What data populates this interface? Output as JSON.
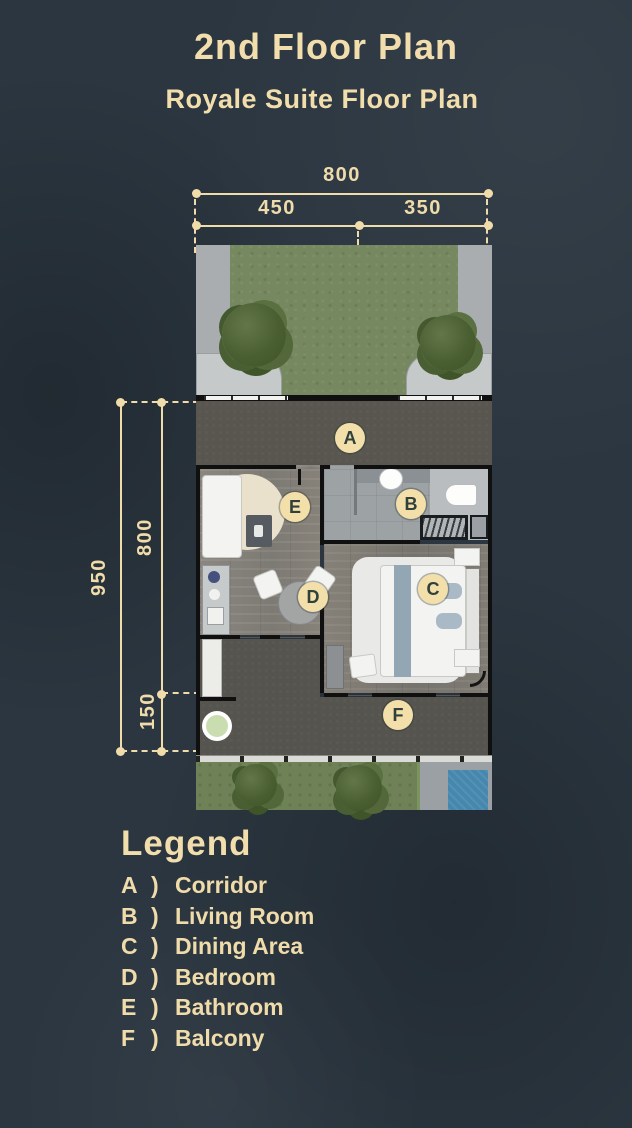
{
  "header": {
    "title": "2nd Floor Plan",
    "subtitle": "Royale Suite Floor Plan"
  },
  "dimensions": {
    "top": {
      "total": "800",
      "segment_left": "450",
      "segment_right": "350"
    },
    "side": {
      "total": "950",
      "segment_upper": "800",
      "segment_lower": "150"
    }
  },
  "plan": {
    "badges": {
      "a": "A",
      "b": "B",
      "c": "C",
      "d": "D",
      "e": "E",
      "f": "F"
    }
  },
  "legend": {
    "title": "Legend",
    "separator": ")",
    "items": [
      {
        "letter": "A",
        "label": "Corridor"
      },
      {
        "letter": "B",
        "label": "Living Room"
      },
      {
        "letter": "C",
        "label": "Dining Area"
      },
      {
        "letter": "D",
        "label": "Bedroom"
      },
      {
        "letter": "E",
        "label": "Bathroom"
      },
      {
        "letter": "F",
        "label": "Balcony"
      }
    ]
  },
  "colors": {
    "background": "#2b3640",
    "accent_cream": "#f0dcab",
    "badge_fill": "#f2dfa9",
    "badge_text": "#30403a",
    "wall": "#101010",
    "corridor_floor": "#58564f",
    "balcony_floor": "#55544e",
    "wood_floor": "#86827c",
    "tile_floor": "#9da2a5",
    "grass": "#76885f",
    "pool": "#4687ae",
    "concrete": "#a9adb0"
  }
}
